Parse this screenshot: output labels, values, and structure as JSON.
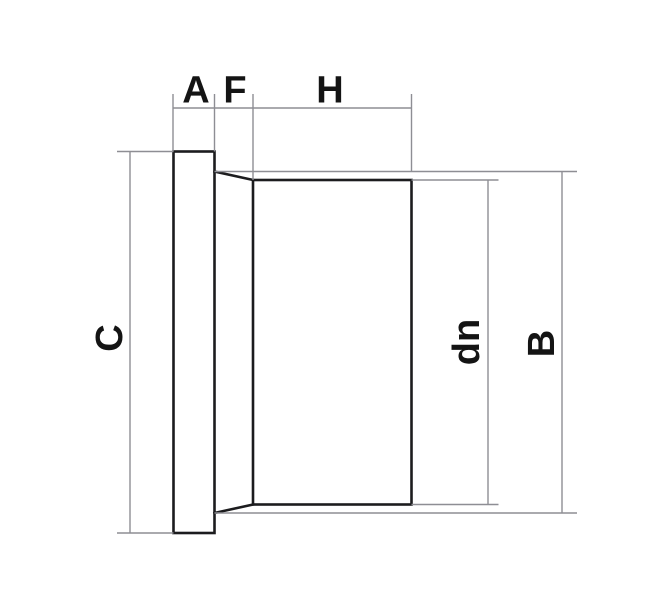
{
  "figure": {
    "labels": {
      "a": "A",
      "f": "F",
      "h": "H",
      "c": "C",
      "dn": "dn",
      "b": "B"
    }
  },
  "colors": {
    "background": "#ffffff",
    "object_line": "#1c1c1e",
    "dimension_line": "#8e8e94",
    "label_text": "#141414"
  }
}
